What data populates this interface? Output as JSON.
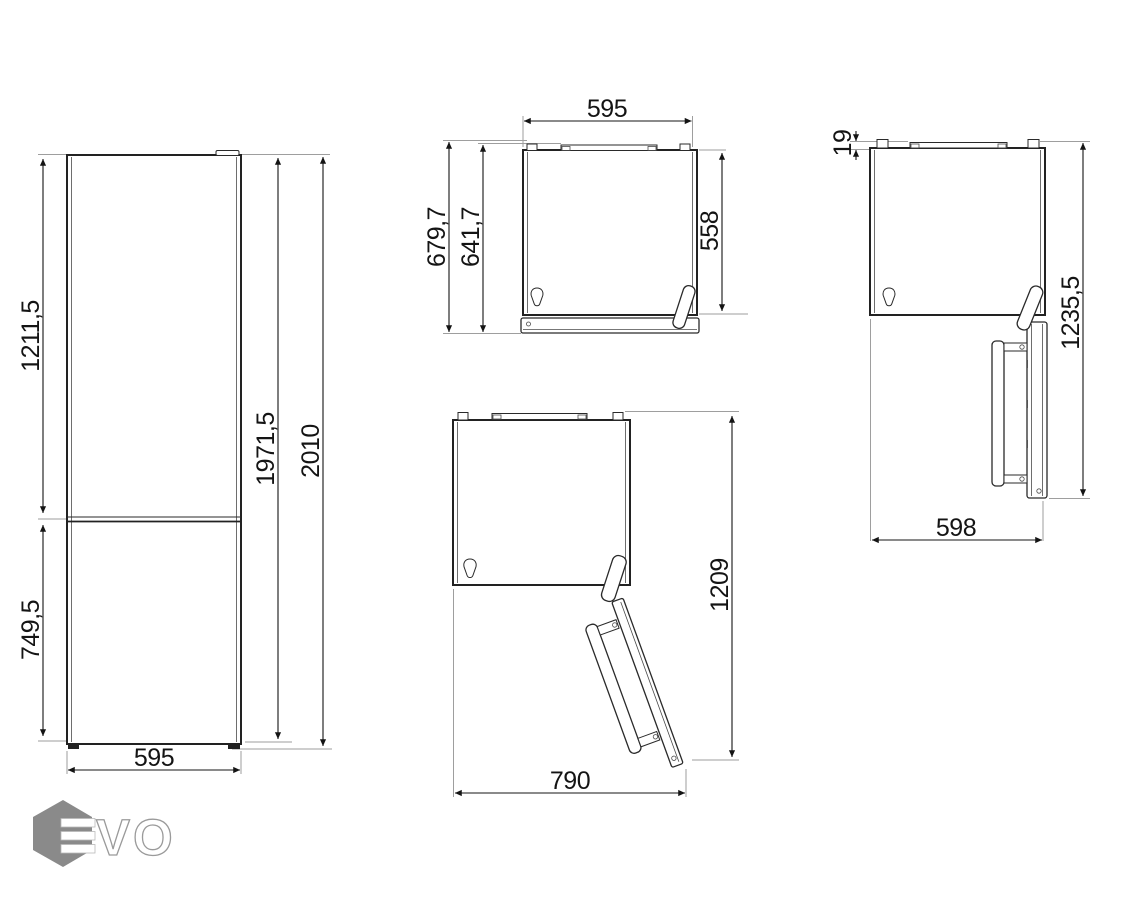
{
  "drawing": {
    "title": "refrigerator-dimension-drawing",
    "views": {
      "front": {
        "dims": {
          "upper_door_height": "1211,5",
          "lower_door_height": "749,5",
          "cabinet_height": "1971,5",
          "total_height": "2010",
          "width": "595"
        }
      },
      "top_closed": {
        "dims": {
          "width": "595",
          "depth_with_handle": "679,7",
          "depth_with_door": "641,7",
          "depth_cabinet": "558"
        }
      },
      "top_open_90": {
        "dims": {
          "rear_spacer": "19",
          "depth_door_open": "1235,5",
          "width_door_open": "598"
        }
      },
      "top_open_135": {
        "dims": {
          "width_door_open": "790",
          "depth_door_open": "1209"
        }
      }
    },
    "logo": {
      "letters_outline": "VO"
    }
  },
  "colors": {
    "background": "#ffffff",
    "object_line": "#222222",
    "dimension_line": "#141414",
    "reference_line": "#9e9e9e",
    "logo_gray": "#8a8a8a"
  }
}
